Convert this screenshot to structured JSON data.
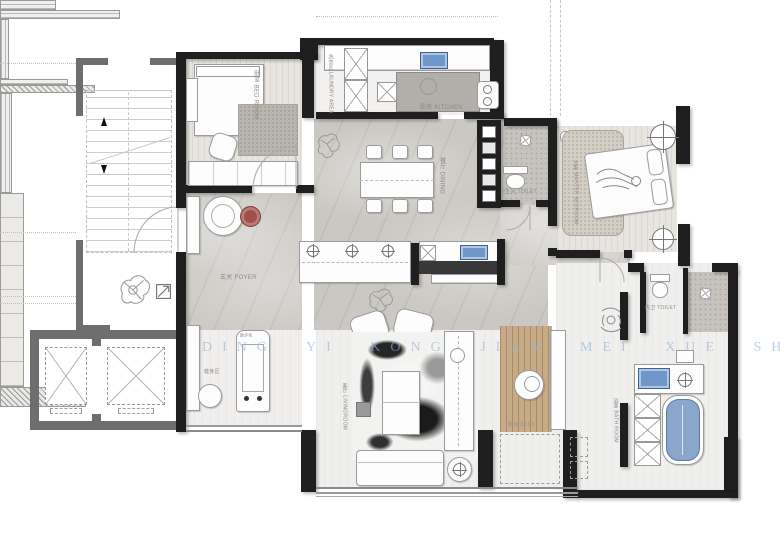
{
  "watermark": {
    "text": "DING YI KONG JIAN MEI XUE SHE JI"
  },
  "labels": {
    "bedroom2": "卧室 BED ROOM",
    "laundry": "洗衣区 LAUNDRY AREA",
    "kitchen": "厨房 KITCHEN",
    "dining": "餐厅 DINING",
    "foyer": "玄关 FOYER",
    "fitness_zone": "健身区",
    "treadmill": "跑步机",
    "guest_toilet": "卫生间 TOILET",
    "master_bedroom": "主卧 MASTER BEDROOM",
    "inner_toilet": "内卫 TOILET",
    "living_room": "客厅 LIVINGROOM",
    "bathroom": "浴室 BATH ROOM",
    "deck": "阳台 23.03"
  },
  "colors": {
    "wall_black": "#1f1f1f",
    "wall_gray": "#6e6e6e",
    "sink_blue": "#6f97c9",
    "tub_blue": "#8ba6cb",
    "plant_green": "#579080",
    "side_table_red": "#a05147",
    "deck_wood": "#c7ab87",
    "watermark_blue": "#94b3d6"
  }
}
